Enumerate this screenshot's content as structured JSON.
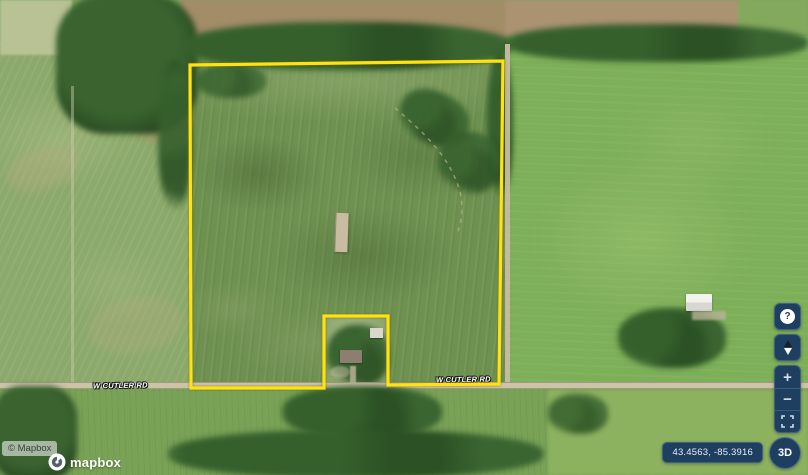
{
  "map": {
    "road_labels": [
      {
        "text": "W CUTLER RD"
      },
      {
        "text": "W CUTLER RD"
      }
    ],
    "attribution_text": "© Mapbox",
    "logo_wordmark": "mapbox"
  },
  "parcel": {
    "outline_color": "#ffe213",
    "points": "190,65 503,61 499,384 388,385 388,316 324,316 324,388 191,388"
  },
  "controls": {
    "panel_color": "#1e3f5f",
    "help_glyph": "?",
    "zoom_in_glyph": "+",
    "zoom_out_glyph": "−",
    "threed_label": "3D",
    "coordinates_value": "43.4563, -85.3916"
  }
}
